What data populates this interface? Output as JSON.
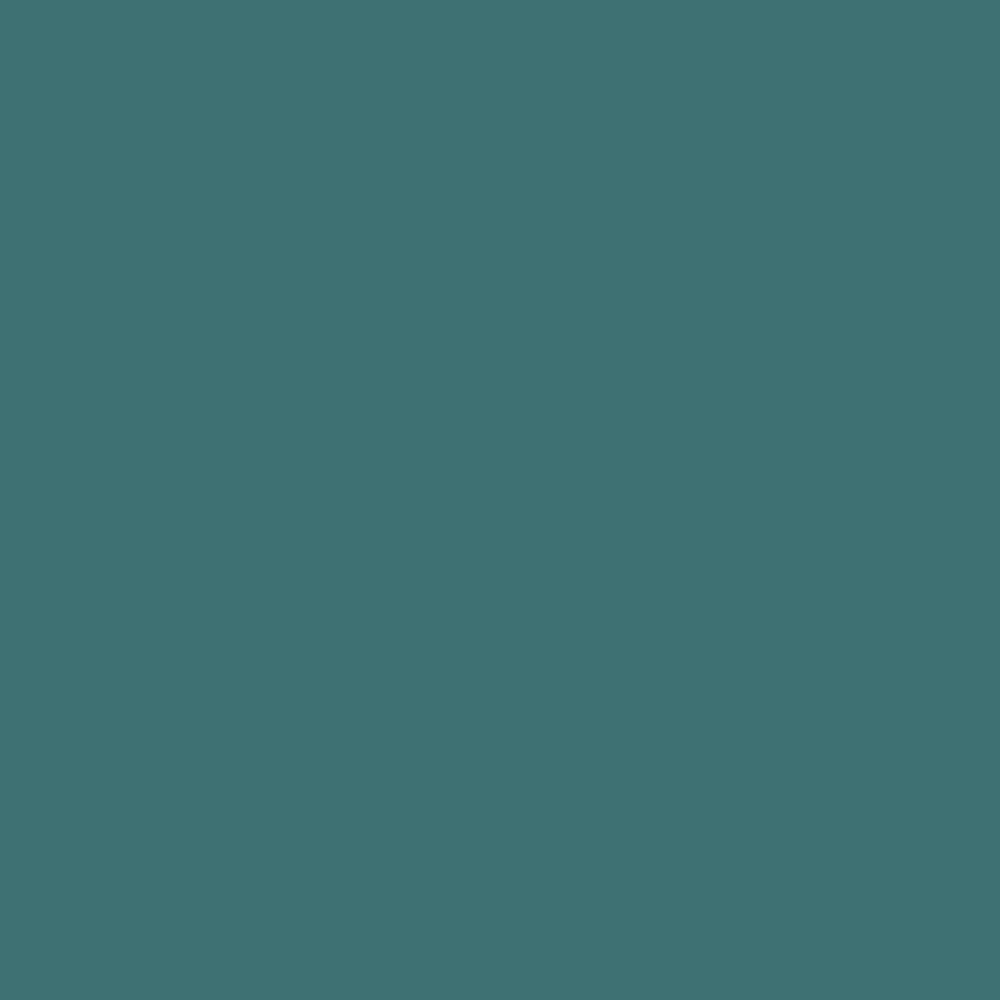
{
  "canvas": {
    "background_color": "#3e7173",
    "description": "uniform solid teal background, no visible text or UI elements"
  }
}
